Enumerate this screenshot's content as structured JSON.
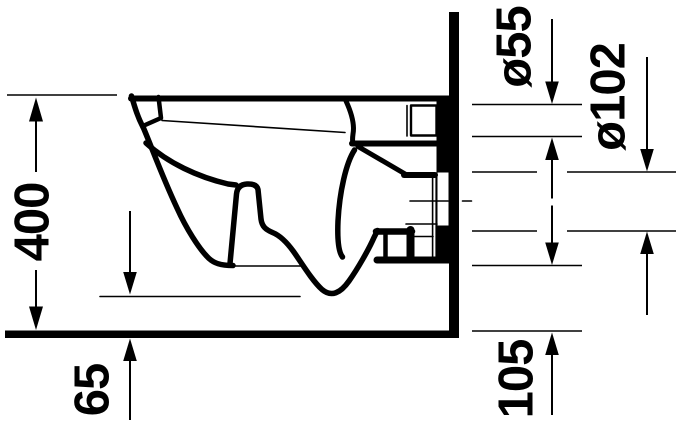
{
  "drawing": {
    "background_color": "#ffffff",
    "line_color": "#000000",
    "subject": "wall-hung-toilet-side-elevation",
    "labels": {
      "overall_height": "400",
      "floor_clearance": "65",
      "flush_connection_diameter": "ø55",
      "outlet_diameter": "ø102",
      "outlet_bottom_height": "105"
    }
  }
}
